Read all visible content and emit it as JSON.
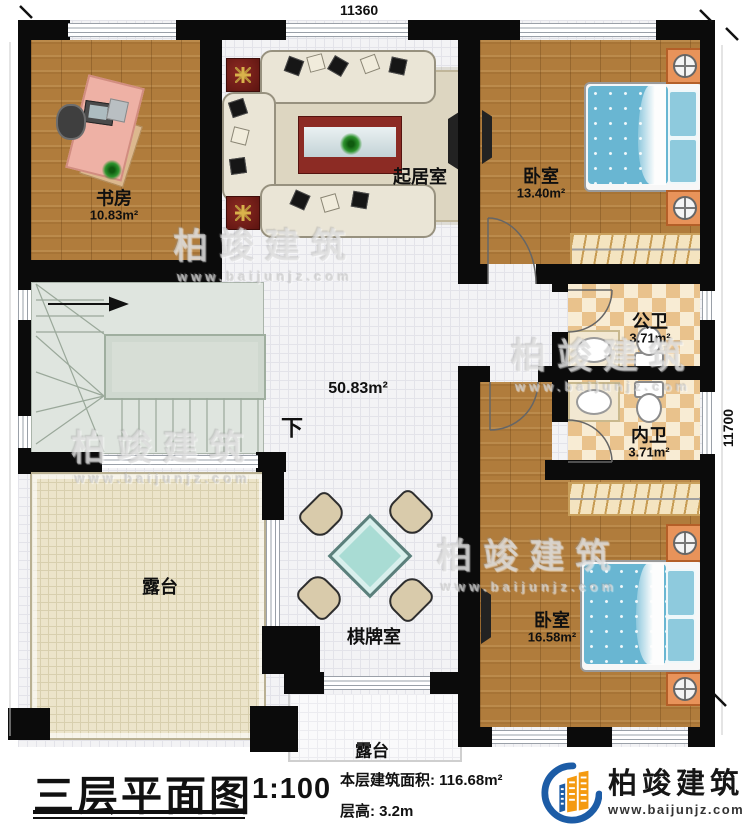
{
  "dimensions": {
    "top": "11360",
    "right": "11700"
  },
  "rooms": {
    "study": {
      "name": "书房",
      "area": "10.83m²"
    },
    "living": {
      "name": "起居室"
    },
    "bedroom1": {
      "name": "卧室",
      "area": "13.40m²"
    },
    "public_bath": {
      "name": "公卫",
      "area": "3.71m²"
    },
    "private_bath": {
      "name": "内卫",
      "area": "3.71m²"
    },
    "bedroom2": {
      "name": "卧室",
      "area": "16.58m²"
    },
    "hall": {
      "area": "50.83m²"
    },
    "terrace_left": {
      "name": "露台"
    },
    "chess_room": {
      "name": "棋牌室"
    },
    "terrace_bottom": {
      "name": "露台"
    }
  },
  "stairs": {
    "direction_label": "下"
  },
  "watermark": {
    "text": "柏竣建筑",
    "url": "www.baijunjz.com"
  },
  "title_block": {
    "title": "三层平面图",
    "scale": "1:100",
    "area_line": "本层建筑面积: 116.68m²",
    "height_line": "层高: 3.2m"
  },
  "logo": {
    "name": "柏竣建筑",
    "url": "www.baijunjz.com"
  },
  "colors": {
    "wall": "#0b0b0b",
    "wood_floor": "#b07c3c",
    "bath_tile": "#e9c28c",
    "terrace_floor": "#ece4ca",
    "stair_floor": "#dfe5df",
    "bed_fabric": "#69b6d2",
    "nightstand": "#e8935a",
    "logo_blue": "#1c5ca6",
    "logo_orange": "#f49a10"
  }
}
